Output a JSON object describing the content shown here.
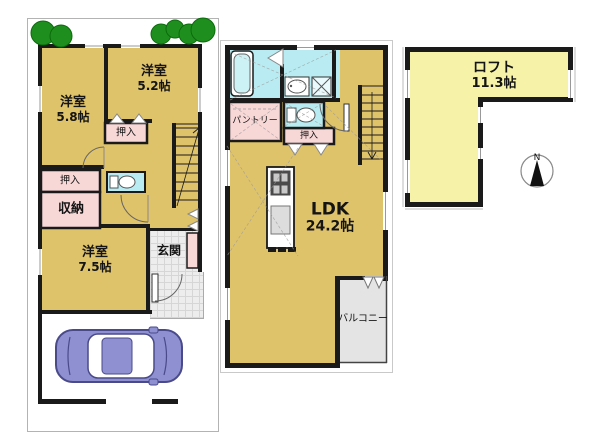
{
  "colors": {
    "wall": "#1a1a1a",
    "room": "#dfc36b",
    "loft": "#f6f3a8",
    "closet": "#f8d7d7",
    "wet": "#b9ecf2",
    "balcony": "#e4e4e4",
    "tree": "#1e8f1e",
    "tree-edge": "#0b6b0b",
    "car": "#8e90d2",
    "car-line": "#4a4a8a"
  },
  "floor1": {
    "bedroom_58": {
      "name": "洋室",
      "area": "5.8帖"
    },
    "bedroom_52": {
      "name": "洋室",
      "area": "5.2帖"
    },
    "bedroom_75": {
      "name": "洋室",
      "area": "7.5帖"
    },
    "closet_upper": "押入",
    "closet_lower": "押入",
    "storage": "収納",
    "entrance": "玄関"
  },
  "floor2": {
    "pantry": "パントリー",
    "closet": "押入",
    "ldk": {
      "name": "LDK",
      "area": "24.2帖"
    },
    "balcony": "バルコニー"
  },
  "loft": {
    "name": "ロフト",
    "area": "11.3帖"
  },
  "compass": {
    "north": "N"
  }
}
